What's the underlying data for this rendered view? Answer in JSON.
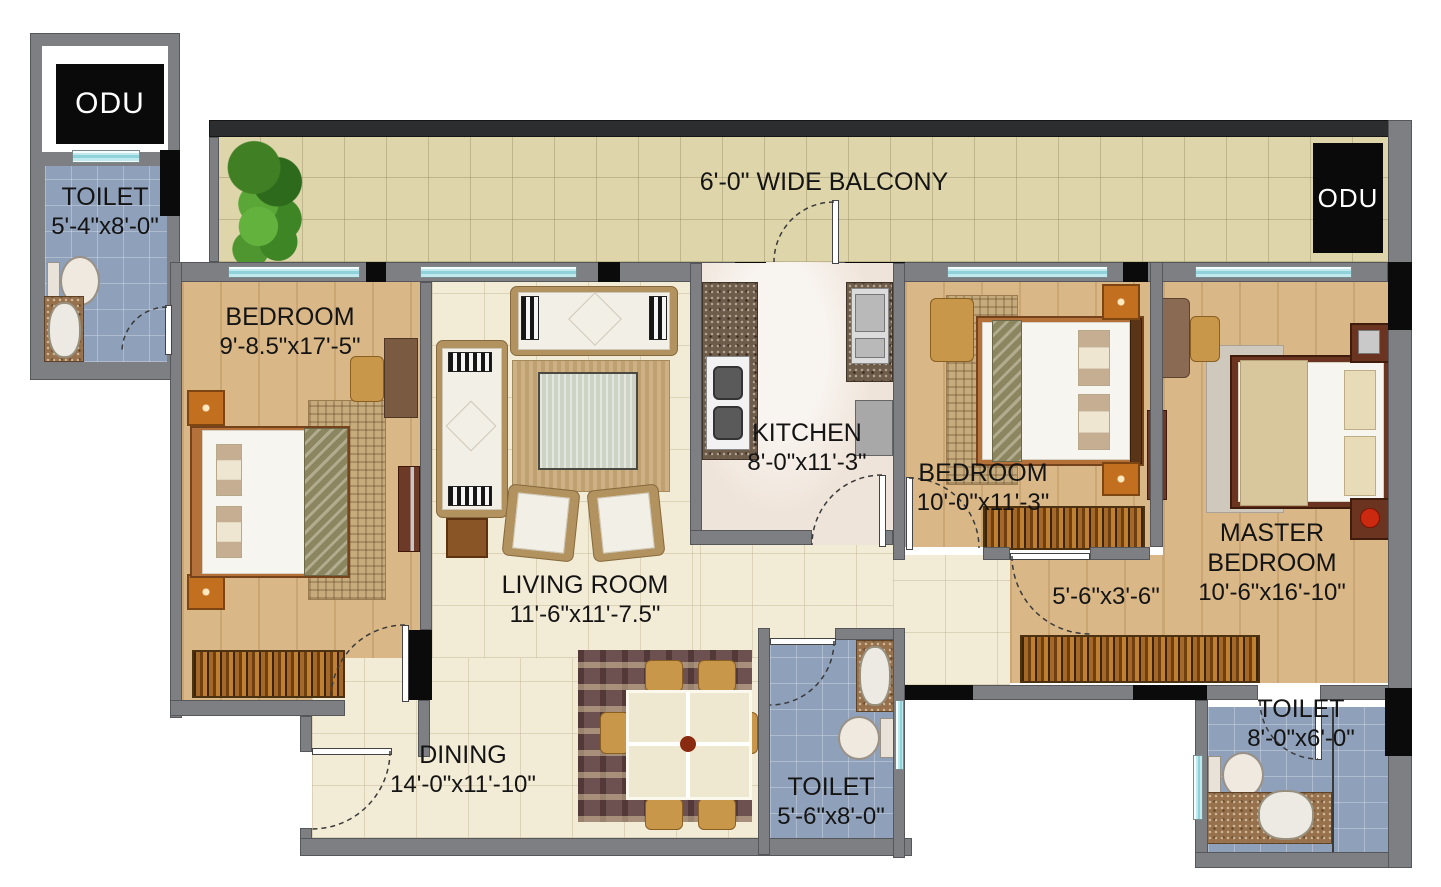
{
  "plan": {
    "balcony": {
      "label": "6'-0\" WIDE BALCONY"
    },
    "odu_left": "ODU",
    "odu_right": "ODU",
    "rooms": {
      "toilet1": {
        "name": "TOILET",
        "dims": "5'-4\"x8'-0\""
      },
      "bedroom1": {
        "name": "BEDROOM",
        "dims": "9'-8.5\"x17'-5\""
      },
      "living": {
        "name": "LIVING ROOM",
        "dims": "11'-6\"x11'-7.5\""
      },
      "kitchen": {
        "name": "KITCHEN",
        "dims": "8'-0\"x11'-3\""
      },
      "bedroom2": {
        "name": "BEDROOM",
        "dims": "10'-0\"x11'-3\""
      },
      "master": {
        "name_line1": "MASTER",
        "name_line2": "BEDROOM",
        "dims": "10'-6\"x16'-10\""
      },
      "passage": {
        "dims": "5'-6\"x3'-6\""
      },
      "dining": {
        "name": "DINING",
        "dims": "14'-0\"x11'-10\""
      },
      "toilet2": {
        "name": "TOILET",
        "dims": "5'-6\"x8'-0\""
      },
      "toilet3": {
        "name": "TOILET",
        "dims": "8'-0\"x6'-0\""
      }
    },
    "colors": {
      "wall": "#7d7f82",
      "wall_dark": "#2c2d2f",
      "post": "#0b0b0b",
      "window_glass": "#bfe9ee",
      "wood_floor": "#d9b786",
      "balcony_tile": "#ded5aa",
      "living_tile": "#f2ebd5",
      "toilet_tile": "#8fa0ba",
      "kitchen_marble": "#efe4d9",
      "wardrobe_wood": "#a4682a",
      "label_text": "#141414"
    }
  }
}
